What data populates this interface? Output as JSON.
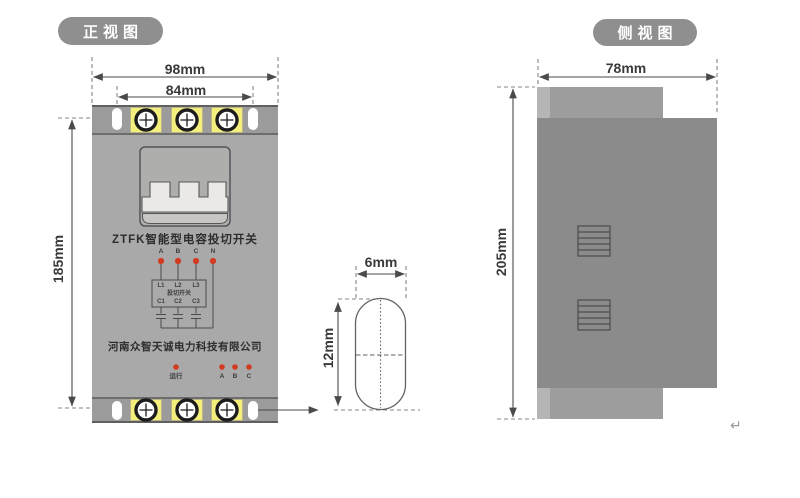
{
  "front_view": {
    "tab_label": "正视图",
    "dim_width_outer": "98mm",
    "dim_hole_spacing": "84mm",
    "dim_height": "185mm",
    "device": {
      "title": "ZTFK智能型电容投切开关",
      "company": "河南众智天诚电力科技有限公司",
      "wiring_diagram": {
        "inputs": [
          "A",
          "B",
          "C",
          "N"
        ],
        "box_inputs": [
          "L1",
          "L2",
          "L3"
        ],
        "box_label": "投切开关",
        "box_outputs": [
          "C1",
          "C2",
          "C3"
        ]
      },
      "indicators": {
        "run": "运行",
        "phases": [
          "A",
          "B",
          "C"
        ]
      }
    }
  },
  "slot_detail": {
    "dim_width": "6mm",
    "dim_height": "12mm"
  },
  "side_view": {
    "tab_label": "侧视图",
    "dim_width": "78mm",
    "dim_height": "205mm"
  },
  "footer": {
    "return_mark": "↵"
  },
  "colors": {
    "terminal_yellow": "#f4ef7d",
    "led_red": "#d23b21",
    "front_body_gray": "#a9a9a9",
    "mount_strip_gray": "#9b9b9b",
    "side_body_gray": "#8b8b8b",
    "label_pill_gray": "#8f8f8f"
  }
}
